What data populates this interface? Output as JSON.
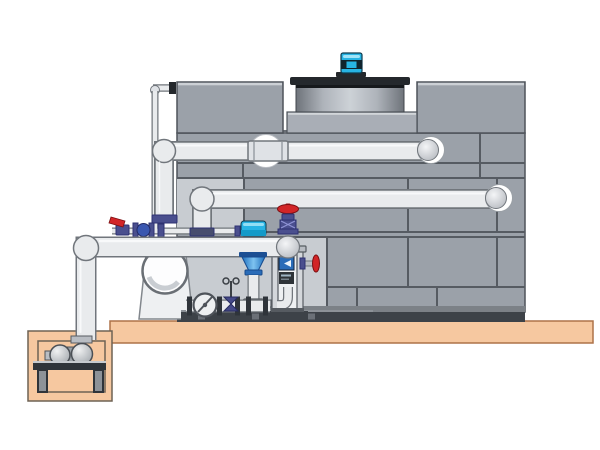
{
  "meta": {
    "title": "Cooling tower installation side-view diagram",
    "canvas_width": "600",
    "canvas_height": "450"
  },
  "colors": {
    "panel": "#9ba1a9",
    "panel_light": "#c8ccd1",
    "seam": "#565b62",
    "dark": "#2f343a",
    "base_dark": "#3d4248",
    "slab": "#f6c8a0",
    "slab_edge": "#ad7248",
    "pit_edge": "#6e6254",
    "pipe": "#e9ebed",
    "pipe_edge": "#71767c",
    "cyan": "#27b4e4",
    "red": "#d22527",
    "purple": "#4a4f8e",
    "purple_dark": "#2e3272",
    "blue": "#2a6cb8",
    "blue_deep": "#1c4f93"
  },
  "components": {
    "cooling_tower": "Cooling tower casing with panel seams",
    "fan_cowl": "Fan discharge cowl on tower deck",
    "fan_motor": "Cyan fan motor",
    "upper_pipe": "Upper return pipe with union and wall elbow",
    "middle_pipe": "Middle supply pipe into tower wall",
    "lower_pipe": "Pump discharge pipe with dome cap",
    "makeup_line": "Thin make-up water line",
    "lever_valve": "Shut-off valve with red lever",
    "check_valve": "Check valve with blue body",
    "branch_valve": "Globe valve with red handwheel",
    "side_valve": "Drain valve with red handwheel",
    "gate_valve": "Gate valve handwheel (face-on)",
    "cross_valve": "Small rising-stem gate valve",
    "vertical_pump": "Vertical float/metering assembly with cyan motor and blue cone",
    "filter_frame": "Instrument stand with gauge and elbow drain",
    "suction_outlet": "Tower suction outlet housing with round opening",
    "skid": "Equipment skid base with flanged piping",
    "floor_slab": "Concrete floor slab",
    "pump_pit": "Recessed pump pit",
    "sump_pump": "Horizontal sump pump on stand"
  }
}
